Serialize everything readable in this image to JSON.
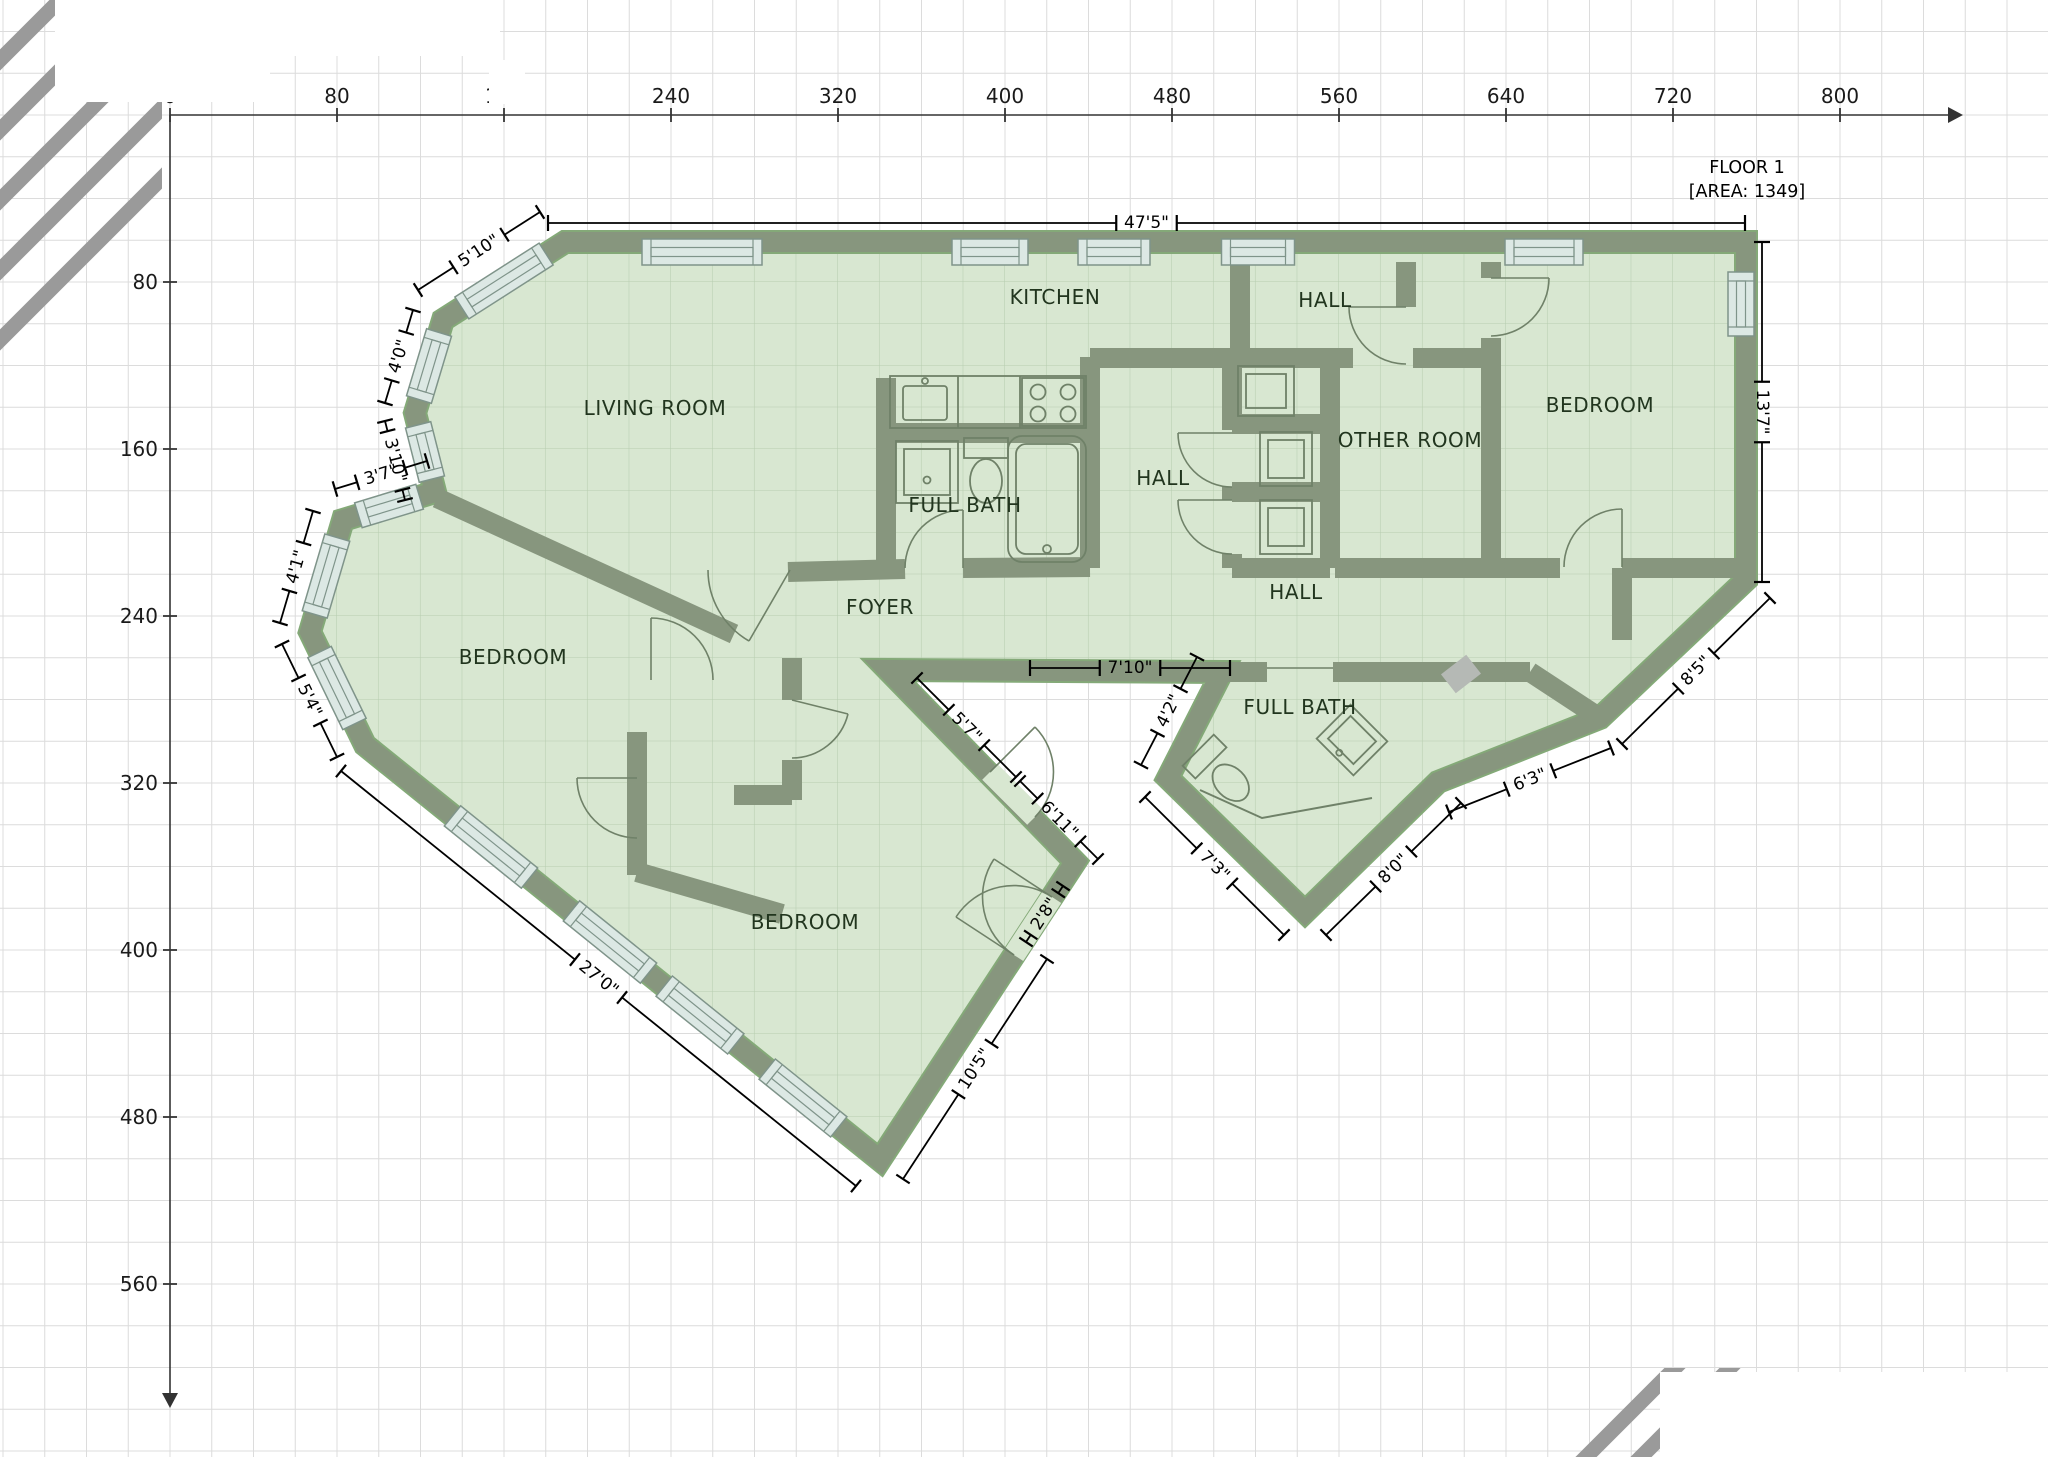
{
  "title": {
    "line1": "FLOOR 1",
    "line2": "[AREA: 1349]",
    "x": 1747,
    "y1": 173,
    "y2": 197
  },
  "rulers": {
    "top": {
      "labels": [
        "0",
        "80",
        "160",
        "240",
        "320",
        "400",
        "480",
        "560",
        "640",
        "720",
        "800"
      ],
      "origin_x": 170,
      "axis_y": 115,
      "step_px": 167
    },
    "left": {
      "labels": [
        "80",
        "160",
        "240",
        "320",
        "400",
        "480",
        "560"
      ],
      "axis_x": 170,
      "origin_y": 115,
      "step_px": 167
    }
  },
  "rooms": [
    {
      "name": "LIVING ROOM",
      "x": 655,
      "y": 408
    },
    {
      "name": "KITCHEN",
      "x": 1055,
      "y": 297
    },
    {
      "name": "HALL",
      "x": 1325,
      "y": 300
    },
    {
      "name": "BEDROOM",
      "x": 1600,
      "y": 405
    },
    {
      "name": "OTHER ROOM",
      "x": 1410,
      "y": 440
    },
    {
      "name": "HALL",
      "x": 1163,
      "y": 478
    },
    {
      "name": "FULL BATH",
      "x": 965,
      "y": 505
    },
    {
      "name": "HALL",
      "x": 1296,
      "y": 592
    },
    {
      "name": "FOYER",
      "x": 880,
      "y": 607
    },
    {
      "name": "BEDROOM",
      "x": 513,
      "y": 657
    },
    {
      "name": "BEDROOM",
      "x": 805,
      "y": 922
    },
    {
      "name": "FULL BATH",
      "x": 1300,
      "y": 707
    }
  ],
  "dimensions": [
    {
      "label": "47'5\"",
      "x1": 548,
      "y1": 223,
      "x2": 1745,
      "y2": 223,
      "rot": 0
    },
    {
      "label": "13'7\"",
      "x1": 1762,
      "y1": 242,
      "x2": 1762,
      "y2": 582,
      "rot": 90
    },
    {
      "label": "8'5\"",
      "x1": 1770,
      "y1": 598,
      "x2": 1622,
      "y2": 744,
      "rot": -45
    },
    {
      "label": "6'3\"",
      "x1": 1449,
      "y1": 812,
      "x2": 1611,
      "y2": 748,
      "rot": -22
    },
    {
      "label": "8'0\"",
      "x1": 1326,
      "y1": 935,
      "x2": 1461,
      "y2": 803,
      "rot": -44
    },
    {
      "label": "7'3\"",
      "x1": 1145,
      "y1": 797,
      "x2": 1284,
      "y2": 935,
      "rot": 45
    },
    {
      "label": "4'2\"",
      "x1": 1141,
      "y1": 765,
      "x2": 1197,
      "y2": 657,
      "rot": -63
    },
    {
      "label": "7'10\"",
      "x1": 1030,
      "y1": 668,
      "x2": 1230,
      "y2": 668,
      "rot": 0
    },
    {
      "label": "5'7\"",
      "x1": 917,
      "y1": 678,
      "x2": 1016,
      "y2": 777,
      "rot": 45
    },
    {
      "label": "6'11\"",
      "x1": 1020,
      "y1": 781,
      "x2": 1098,
      "y2": 859,
      "rot": 45
    },
    {
      "label": "2'8\"",
      "x1": 1063,
      "y1": 886,
      "x2": 1026,
      "y2": 942,
      "rot": -57
    },
    {
      "label": "10'5\"",
      "x1": 1047,
      "y1": 959,
      "x2": 903,
      "y2": 1179,
      "rot": -57
    },
    {
      "label": "27'0\"",
      "x1": 341,
      "y1": 771,
      "x2": 856,
      "y2": 1186,
      "rot": 39
    },
    {
      "label": "5'10\"",
      "x1": 540,
      "y1": 212,
      "x2": 418,
      "y2": 290,
      "rot": -33
    },
    {
      "label": "4'0\"",
      "x1": 413,
      "y1": 310,
      "x2": 385,
      "y2": 403,
      "rot": -73
    },
    {
      "label": "3'10\"",
      "x1": 385,
      "y1": 421,
      "x2": 405,
      "y2": 500,
      "rot": 76
    },
    {
      "label": "3'7\"",
      "x1": 427,
      "y1": 461,
      "x2": 335,
      "y2": 489,
      "rot": -17
    },
    {
      "label": "4'1\"",
      "x1": 313,
      "y1": 511,
      "x2": 280,
      "y2": 623,
      "rot": -74
    },
    {
      "label": "5'4\"",
      "x1": 282,
      "y1": 644,
      "x2": 337,
      "y2": 757,
      "rot": 64
    }
  ],
  "colors": {
    "wall": "#87967e",
    "wall_edge": "#84a978",
    "room_fill": "#d8e7d1",
    "room_grid": "#b7cdb0",
    "window_fill": "#dce8e4",
    "window_frame": "#7f948a",
    "thin_line": "#6f8168",
    "grid": "#dcdcdc",
    "hatch": "#9a9a9a",
    "axis": "#333333",
    "gray_block": "#b5b9b5"
  }
}
